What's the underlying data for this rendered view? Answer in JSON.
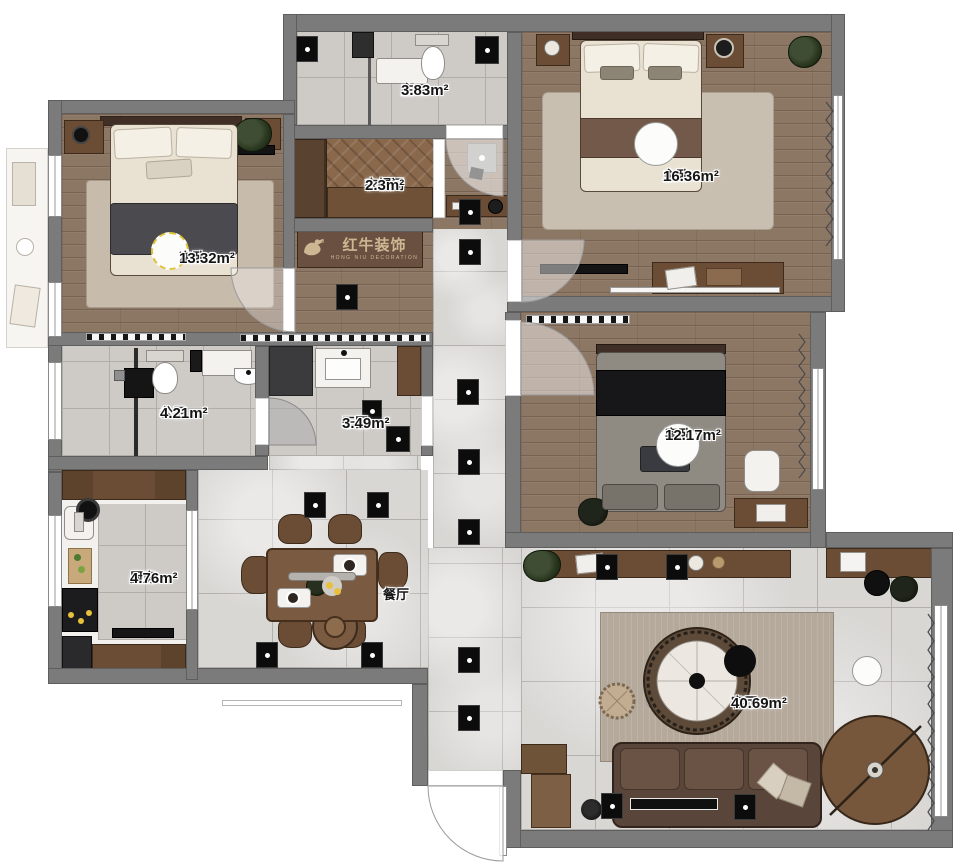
{
  "brand": {
    "name": "红牛装饰",
    "sub": "HONG NIU DECORATION"
  },
  "rooms": [
    {
      "name": "次卧",
      "area": "13.32m²"
    },
    {
      "name": "主卫",
      "area": "3.83m²"
    },
    {
      "name": "衣帽间",
      "area": "2.3m²"
    },
    {
      "name": "主卧",
      "area": "16.36m²"
    },
    {
      "name": "客卧",
      "area": "12.17m²"
    },
    {
      "name": "公卫",
      "area": "4.21m²"
    },
    {
      "name": "干区",
      "area": "3.49m²"
    },
    {
      "name": "厨房",
      "area": "4.76m²"
    },
    {
      "name": "餐厅",
      "area": ""
    },
    {
      "name": "客厅",
      "area": "40.69m²"
    }
  ],
  "colors": {
    "wall": "#7b7b7b",
    "wood_floor": "#8c7664",
    "tile_floor": "#d9d7d4",
    "brand_bg": "#6a5040",
    "brand_text": "#cbb893",
    "accent_ring": "#ddc33e"
  }
}
